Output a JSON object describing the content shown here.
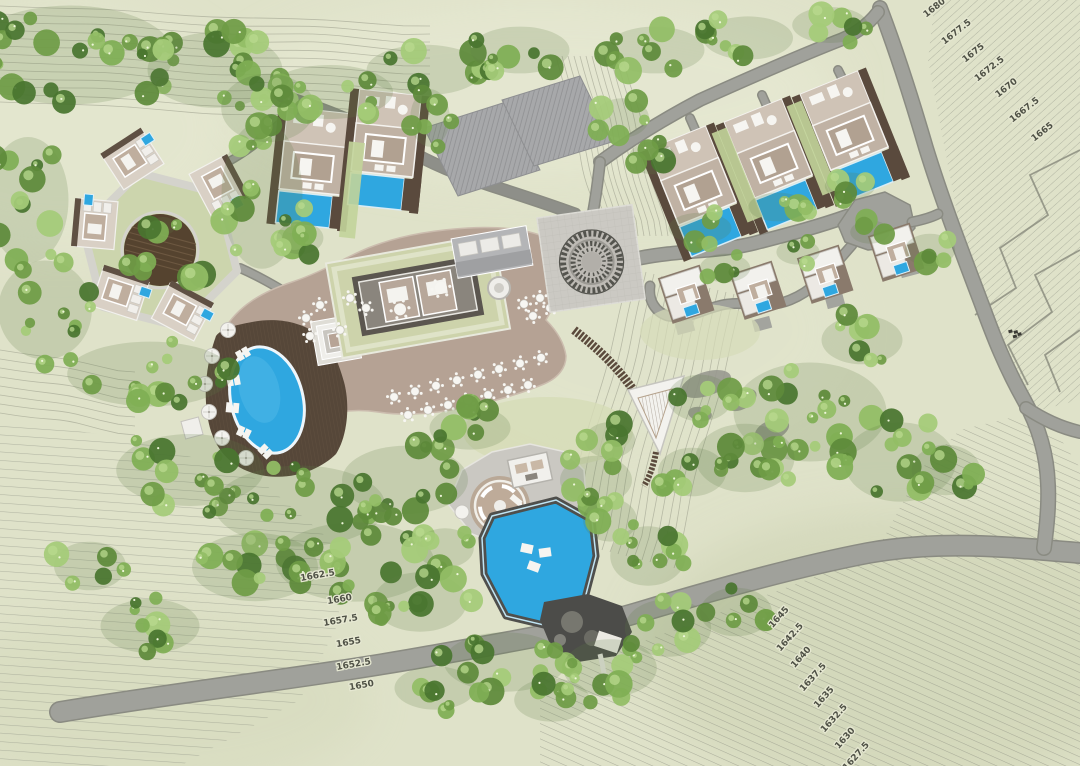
{
  "map": {
    "type": "resort-master-site-plan",
    "contour_labels": [
      {
        "text": "1680",
        "x": 936,
        "y": 10,
        "angle": -38
      },
      {
        "text": "1677.5",
        "x": 958,
        "y": 34,
        "angle": -38
      },
      {
        "text": "1675",
        "x": 975,
        "y": 55,
        "angle": -38
      },
      {
        "text": "1672.5",
        "x": 991,
        "y": 71,
        "angle": -38
      },
      {
        "text": "1670",
        "x": 1008,
        "y": 90,
        "angle": -38
      },
      {
        "text": "1667.5",
        "x": 1026,
        "y": 112,
        "angle": -38
      },
      {
        "text": "1665",
        "x": 1044,
        "y": 134,
        "angle": -38
      },
      {
        "text": "1662.5",
        "x": 318,
        "y": 578,
        "angle": -10
      },
      {
        "text": "1660",
        "x": 340,
        "y": 602,
        "angle": -10
      },
      {
        "text": "1657.5",
        "x": 341,
        "y": 623,
        "angle": -10
      },
      {
        "text": "1655",
        "x": 349,
        "y": 645,
        "angle": -10
      },
      {
        "text": "1652.5",
        "x": 354,
        "y": 667,
        "angle": -10
      },
      {
        "text": "1650",
        "x": 362,
        "y": 688,
        "angle": -10
      },
      {
        "text": "1645",
        "x": 781,
        "y": 619,
        "angle": -48
      },
      {
        "text": "1642.5",
        "x": 792,
        "y": 639,
        "angle": -48
      },
      {
        "text": "1640",
        "x": 803,
        "y": 659,
        "angle": -48
      },
      {
        "text": "1637.5",
        "x": 815,
        "y": 679,
        "angle": -48
      },
      {
        "text": "1635",
        "x": 826,
        "y": 699,
        "angle": -48
      },
      {
        "text": "1632.5",
        "x": 836,
        "y": 720,
        "angle": -48
      },
      {
        "text": "1630",
        "x": 847,
        "y": 740,
        "angle": -48
      },
      {
        "text": "1627.5",
        "x": 858,
        "y": 758,
        "angle": -48
      }
    ],
    "site_marker": {
      "x": 1014,
      "y": 333
    },
    "features": [
      "hex-villa-cluster",
      "twin-pool-villas",
      "service-buildings",
      "arrival-plaza-medallion",
      "main-pavilion-restaurant",
      "oval-pool",
      "terrace-dining",
      "ridge-pool-villas",
      "hillside-villas",
      "lookout-triangle",
      "spa-pavilion",
      "event-pool",
      "rock-deck",
      "access-roads",
      "terraced-fields",
      "forest-canopy"
    ],
    "colors": {
      "terrain": "#dfe2c9",
      "contour": "#8f9180",
      "road": "#a0a19b",
      "road_casing": "#8a8b82",
      "pool_blue": "#2fa7e0",
      "deck_wood": "#564739",
      "deck_tan": "#b5a294",
      "plaza": "#cbc9c3",
      "roof_white": "#f2f1ee",
      "roof_gray": "#a7a8aa",
      "roof_green": "#cdd3ab",
      "tree_dark": "#5e8a3a",
      "tree_mid": "#7fae54",
      "tree_light": "#a5cb79"
    }
  }
}
